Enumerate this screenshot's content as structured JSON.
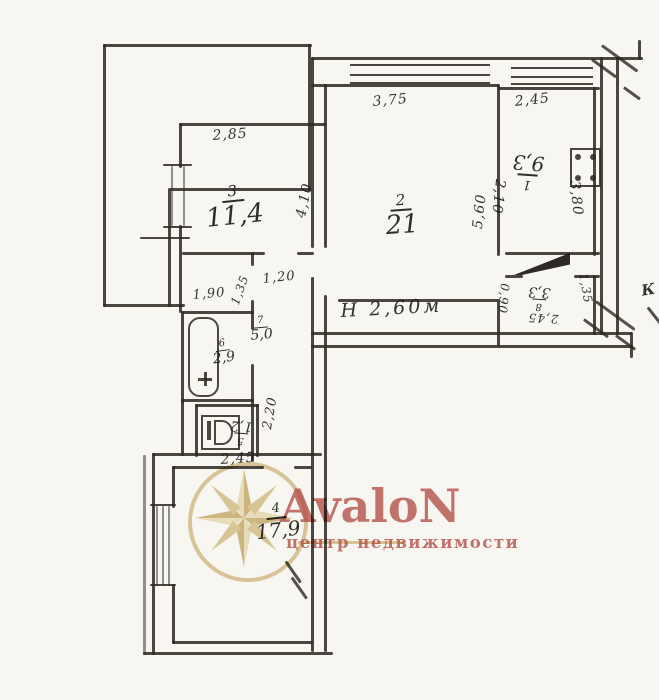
{
  "scan": {
    "watermark": {
      "brand": "AvaloN",
      "tagline": "центр недвижимости",
      "brand_color": "#b8504a",
      "gold_color": "#d5bd87"
    },
    "annotations": {
      "ceiling_height": "Н 2,60м",
      "corner_letter": "К"
    },
    "rooms": [
      {
        "number": "1",
        "area": "9,3",
        "dims": {
          "top": "2,45",
          "left": "2,10",
          "right": "3,80"
        }
      },
      {
        "number": "2",
        "area": "21",
        "dims": {
          "top": "3,75",
          "right": "5,60"
        }
      },
      {
        "number": "3",
        "area": "11,4",
        "dims": {
          "top": "2,85",
          "right": "4,10"
        }
      },
      {
        "number": "4",
        "area": "17,9",
        "dims": {
          "top": "2,45"
        }
      },
      {
        "number": "5",
        "area": "1,2",
        "dims": {}
      },
      {
        "number": "6",
        "area": "2,9",
        "dims": {
          "top": "1,90",
          "side": "1,35"
        }
      },
      {
        "number": "7",
        "area": "5,0",
        "dims": {
          "top": "1,20",
          "side": "2,20"
        }
      },
      {
        "number": "8",
        "area": "3,3",
        "dims": {
          "left": "0,90",
          "right": "1,35",
          "bottom": "2,45"
        }
      }
    ]
  }
}
